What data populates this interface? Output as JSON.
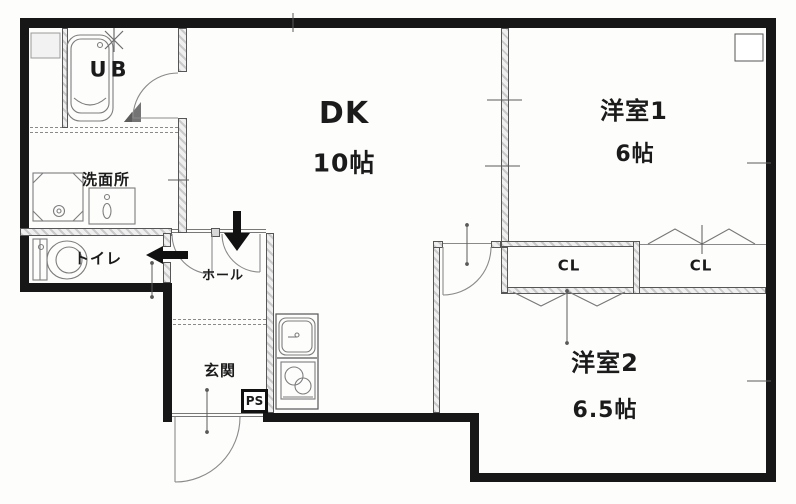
{
  "rooms": {
    "dk": {
      "name": "DK",
      "size": "10帖"
    },
    "western1": {
      "name": "洋室1",
      "size": "6帖"
    },
    "western2": {
      "name": "洋室2",
      "size": "6.5帖"
    },
    "bath": {
      "name": "UB"
    },
    "washroom": {
      "name": "洗面所"
    },
    "toilet": {
      "name": "トイレ"
    },
    "hall": {
      "name": "ホール"
    },
    "entrance": {
      "name": "玄関"
    },
    "closet1": {
      "name": "CL"
    },
    "closet2": {
      "name": "CL"
    },
    "pipe_space": {
      "name": "PS"
    }
  },
  "colors": {
    "wall": "#171717",
    "line": "#8a8a8a",
    "text": "#1b1b1b"
  }
}
